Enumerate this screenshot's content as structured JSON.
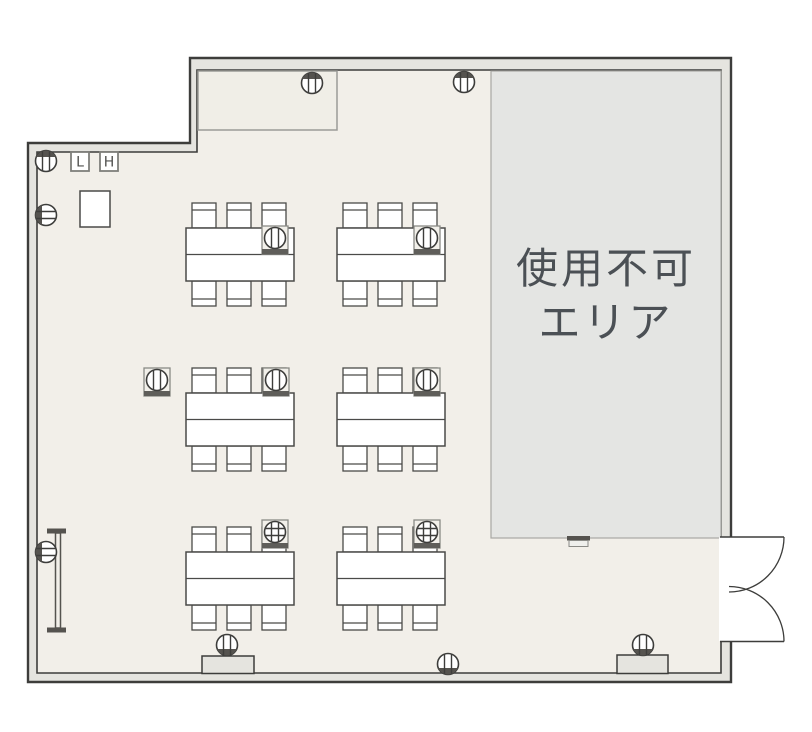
{
  "labels": {
    "unusable_area_line1": "使用不可",
    "unusable_area_line2": "エリア",
    "switch_low": "L",
    "switch_high": "H"
  },
  "colors": {
    "page_background": "#ffffff",
    "floor": "#f2efe9",
    "wall_fill": "#e5e4df",
    "wall_stroke": "#3d3d3b",
    "unusable_fill": "#e4e5e3",
    "unusable_border": "#a8a8a4",
    "unusable_text": "#4b5055",
    "furniture_fill": "#ffffff",
    "furniture_stroke": "#4a4a48",
    "symbol_dark": "#55534f",
    "tap_border": "#8a8a86",
    "tap_fill": "#f2f0ea",
    "tap_bar": "#5f5e5a"
  },
  "floor_plan": {
    "seats_per_table": 6,
    "table_count": 6,
    "tables": [
      {
        "id": "table-1",
        "x": 186,
        "y": 228,
        "tap": {
          "x": 262,
          "y": 226,
          "style": "vertical"
        }
      },
      {
        "id": "table-2",
        "x": 337,
        "y": 228,
        "tap": {
          "x": 414,
          "y": 226,
          "style": "vertical"
        }
      },
      {
        "id": "table-3",
        "x": 186,
        "y": 393,
        "tap": {
          "x": 263,
          "y": 368,
          "style": "vertical"
        }
      },
      {
        "id": "table-4",
        "x": 337,
        "y": 393,
        "tap": {
          "x": 414,
          "y": 368,
          "style": "vertical"
        }
      },
      {
        "id": "table-5",
        "x": 186,
        "y": 552,
        "tap": {
          "x": 262,
          "y": 520,
          "style": "grid"
        }
      },
      {
        "id": "table-6",
        "x": 337,
        "y": 552,
        "tap": {
          "x": 414,
          "y": 520,
          "style": "grid"
        }
      }
    ],
    "table_size": {
      "w": 108,
      "h": 53
    },
    "chair_size": {
      "w": 24,
      "h": 25
    },
    "chair_offsets": [
      6,
      41,
      76
    ],
    "free_taps": [
      {
        "x": 144,
        "y": 368,
        "style": "vertical"
      }
    ],
    "wall_outlets": [
      {
        "x": 312,
        "y": 83,
        "lines": "v",
        "dark": "top"
      },
      {
        "x": 464,
        "y": 82,
        "lines": "v",
        "dark": "top"
      },
      {
        "x": 46,
        "y": 161,
        "lines": "v",
        "dark": "top"
      },
      {
        "x": 46,
        "y": 215,
        "lines": "h",
        "dark": "left"
      },
      {
        "x": 46,
        "y": 552,
        "lines": "h",
        "dark": "left"
      },
      {
        "x": 227,
        "y": 645,
        "lines": "v",
        "dark": "bottom"
      },
      {
        "x": 643,
        "y": 645,
        "lines": "v",
        "dark": "bottom"
      },
      {
        "x": 448,
        "y": 664,
        "lines": "v",
        "dark": "bottom"
      }
    ],
    "pillars": [
      {
        "x": 202,
        "y": 656,
        "w": 52,
        "h": 17.5
      },
      {
        "x": 617,
        "y": 655,
        "w": 51,
        "h": 18.5
      }
    ]
  }
}
